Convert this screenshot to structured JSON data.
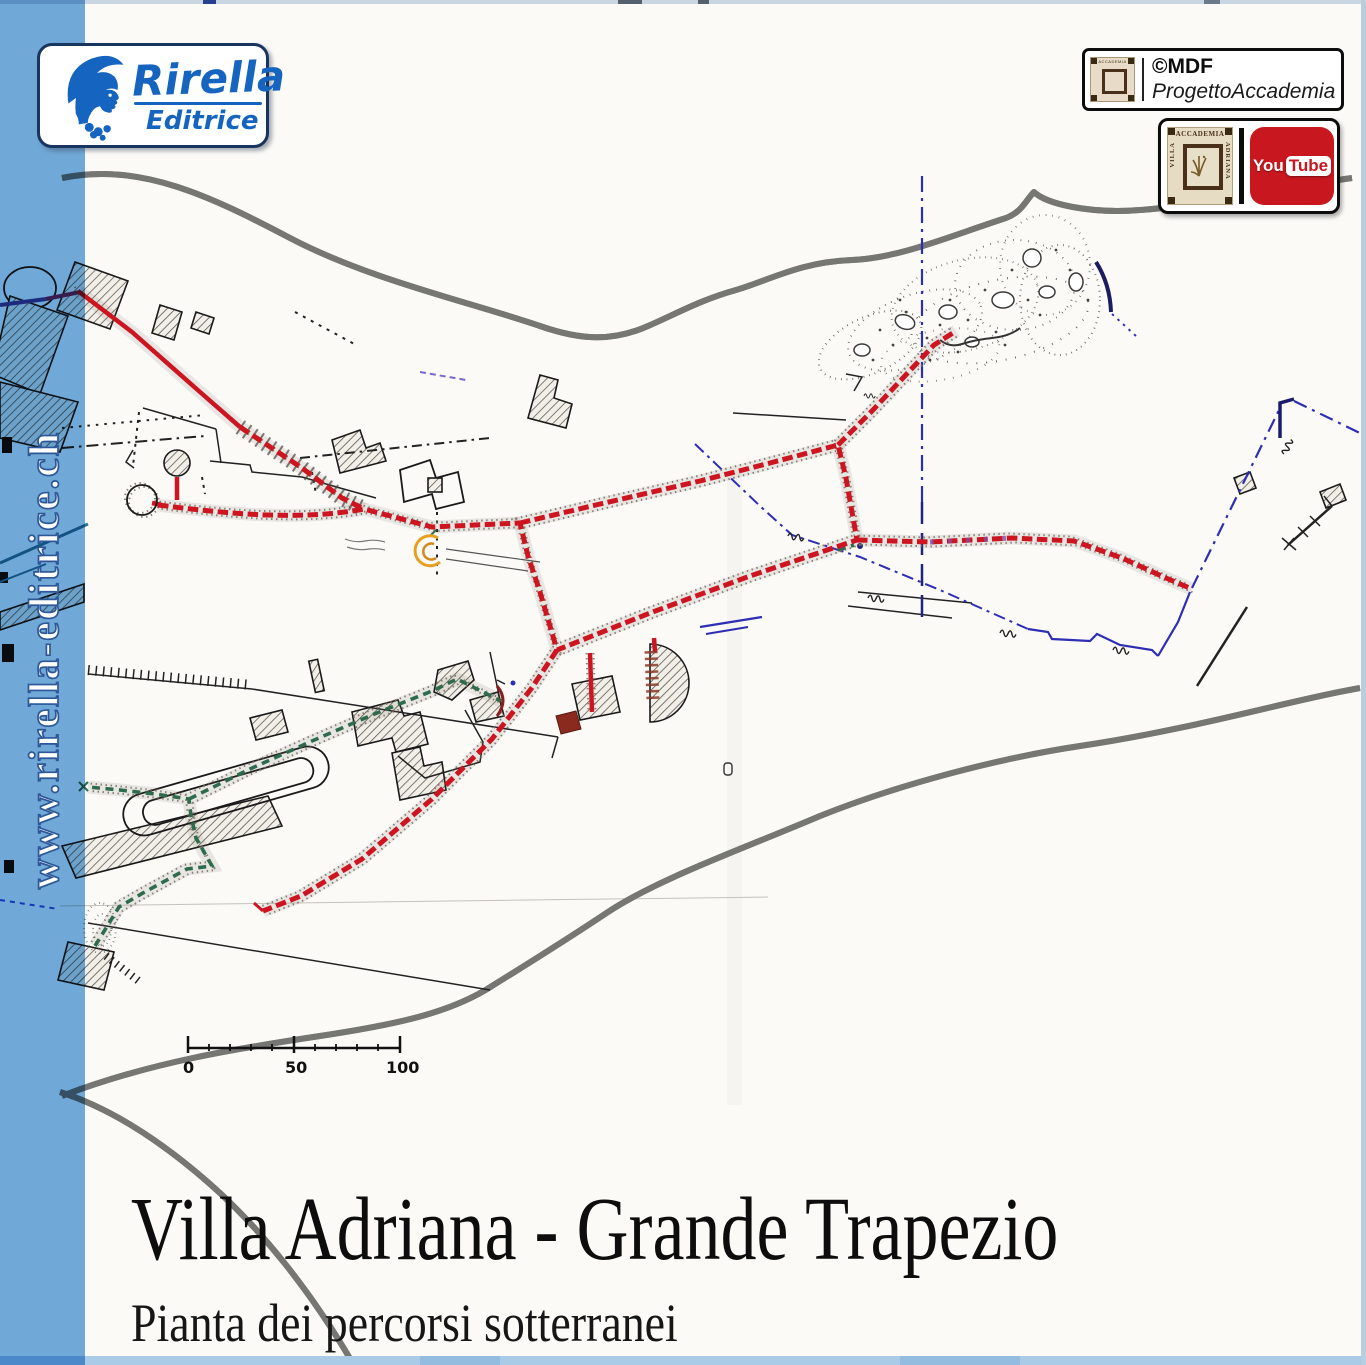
{
  "branding": {
    "publisher": "Rirella",
    "publisher_sub": "Editrice",
    "website": "www.rirella-editrice.ch",
    "logo_icon": "athena-helmet-head-icon",
    "logo_blue": "#1565c0",
    "stripe_blue": "#72acde"
  },
  "badges": {
    "copyright": {
      "line1": "©MDF",
      "line2": "ProgettoAccademia"
    },
    "seal": {
      "top": "ACCADEMIA",
      "left": "VILLA",
      "right": "ADRIANA"
    },
    "youtube": {
      "you": "You",
      "tube": "Tube",
      "red": "#c8171e"
    }
  },
  "map": {
    "scale_bar": {
      "labels": [
        "0",
        "50",
        "100"
      ]
    },
    "legend_colors": {
      "main_underground_route_red": "#cc1520",
      "secondary_route_green": "#2e6b4c",
      "survey_lines_blue": "#2e2eb4",
      "roads_gray": "#767672",
      "paper": "#fbfaf7"
    }
  },
  "footer": {
    "title": "Villa Adriana - Grande Trapezio",
    "subtitle": "Pianta dei percorsi sotterranei"
  }
}
